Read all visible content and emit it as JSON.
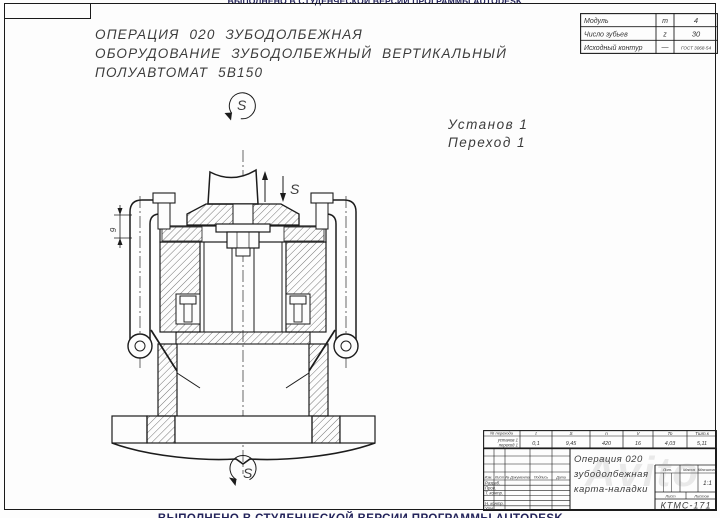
{
  "banner": {
    "text": "ВЫПОЛНЕНО В СТУДЕНЧЕСКОЙ ВЕРСИИ ПРОГРАММЫ AUTODESK"
  },
  "operation_header": {
    "line1": "ОПЕРАЦИЯ 020  ЗУБОДОЛБЕЖНАЯ",
    "line2": "ОБОРУДОВАНИЕ  ЗУБОДОЛБЕЖНЫЙ  ВЕРТИКАЛЬНЫЙ",
    "line3": "ПОЛУАВТОМАТ 5В150"
  },
  "gear_params": {
    "rows": [
      {
        "name": "Модуль",
        "symbol": "m",
        "value": "4"
      },
      {
        "name": "Число зубьев",
        "symbol": "z",
        "value": "30"
      },
      {
        "name": "Исходный контур",
        "symbol": "—",
        "value": "ГОСТ 3068-54"
      }
    ]
  },
  "setup": {
    "line1": "Установ 1",
    "line2": "Переход 1"
  },
  "drawing": {
    "spindle_rotation_label": "S",
    "stroke_label": "S",
    "table_rotation_label": "S",
    "dim_height": "9"
  },
  "cutting_table": {
    "col0_header": "№ перехода",
    "headers": [
      "t",
      "S",
      "n",
      "V",
      "To",
      "Тшт.к"
    ],
    "row_label_line1": "установ 1",
    "row_label_line2": "переход 1",
    "values": [
      "0,1",
      "9,45",
      "420",
      "16",
      "4,03",
      "5,11"
    ]
  },
  "title_block": {
    "sign_cols": [
      "Изм.",
      "Лист",
      "№ Документа",
      "Подпись",
      "Дата"
    ],
    "roles": [
      "Разраб.",
      "Пров.",
      "Т. контр.",
      "Н. контр.",
      "Утв."
    ],
    "title_line1": "Операция 020",
    "title_line2": "зубодолбежная",
    "title_line3": "карта-наладки",
    "lit_label": "Лит.",
    "mass_label": "Масса",
    "scale_label": "Масштаб",
    "scale_value": "1:1",
    "sheet_label": "Лист",
    "sheets_label": "Листов",
    "doc_number": "КТМС-171"
  },
  "watermark": "Avito",
  "colors": {
    "line": "#1c1c1c",
    "text": "#3a3a3a",
    "banner": "#23235a"
  }
}
